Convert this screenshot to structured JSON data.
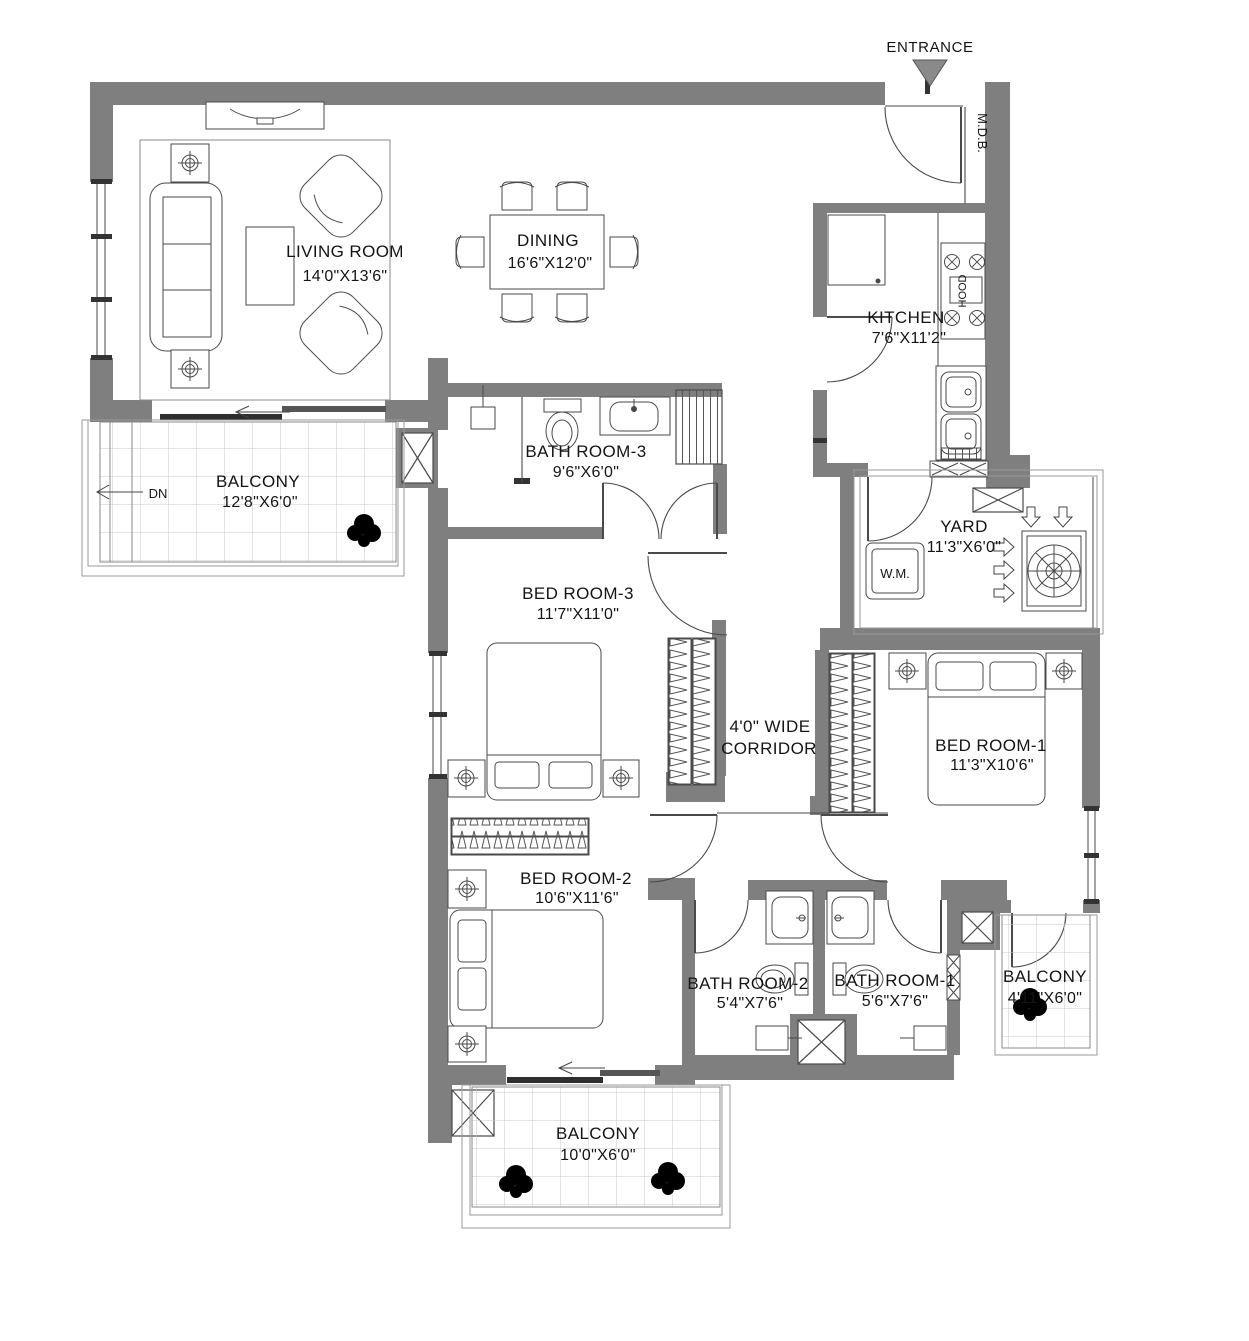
{
  "plan": {
    "title": "3 BHK Apartment Floor Plan",
    "entrance_label": "ENTRANCE",
    "mdb_label": "M.D.B.",
    "dn_label": "DN",
    "wm_label": "W.M.",
    "hood_label": "HOOD",
    "rooms": {
      "living": {
        "name": "LIVING ROOM",
        "size": "14'0\"X13'6\""
      },
      "dining": {
        "name": "DINING",
        "size": "16'6\"X12'0\""
      },
      "kitchen": {
        "name": "KITCHEN",
        "size": "7'6\"X11'2\""
      },
      "yard": {
        "name": "YARD",
        "size": "11'3\"X6'0\""
      },
      "bathroom3": {
        "name": "BATH ROOM-3",
        "size": "9'6\"X6'0\""
      },
      "bedroom3": {
        "name": "BED ROOM-3",
        "size": "11'7\"X11'0\""
      },
      "corridor": {
        "name": "4'0\" WIDE",
        "size": "CORRIDOR"
      },
      "bedroom1": {
        "name": "BED ROOM-1",
        "size": "11'3\"X10'6\""
      },
      "bedroom2": {
        "name": "BED ROOM-2",
        "size": "10'6\"X11'6\""
      },
      "bathroom2": {
        "name": "BATH ROOM-2",
        "size": "5'4\"X7'6\""
      },
      "bathroom1": {
        "name": "BATH ROOM-1",
        "size": "5'6\"X7'6\""
      },
      "balcony_top": {
        "name": "BALCONY",
        "size": "12'8\"X6'0\""
      },
      "balcony_right": {
        "name": "BALCONY",
        "size": "4'11\"X6'0\""
      },
      "balcony_bottom": {
        "name": "BALCONY",
        "size": "10'0\"X6'0\""
      }
    },
    "colors": {
      "wall": "#7f7f7f",
      "line": "#4a4a4a",
      "text": "#141414",
      "tile_line": "#c9c9c9"
    }
  }
}
